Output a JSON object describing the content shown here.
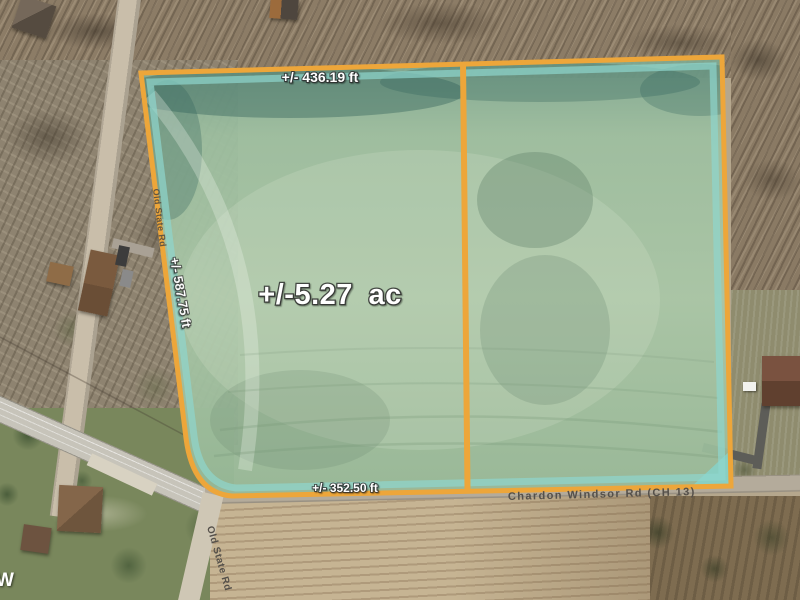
{
  "map": {
    "description": "Aerial property parcel map",
    "watermark": "W"
  },
  "parcel": {
    "area_label": "+/-5.27 ac",
    "top_length": "+/- 436.19 ft",
    "left_length": "+/- 587.75 ft",
    "bottom_length": "+/- 352.50 ft",
    "boundary_color": "#eda63a",
    "highlight_color": "#8ed6cd",
    "fill_color": "#a9c7a7"
  },
  "roads": {
    "old_state_upper": "Old State Rd",
    "old_state_lower": "Old State Rd",
    "chardon_windsor": "Chardon Windsor Rd (CH 13)"
  }
}
